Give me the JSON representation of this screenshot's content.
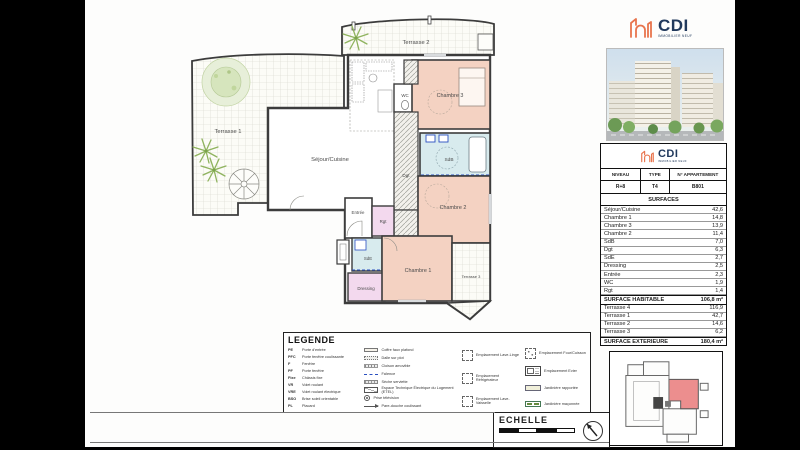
{
  "branding": {
    "name": "CDI",
    "tagline": "IMMOBILIER NEUF"
  },
  "info_table": {
    "headers": [
      "NIVEAU",
      "TYPE",
      "N° APPARTEMENT"
    ],
    "values": [
      "R+8",
      "T4",
      "B801"
    ],
    "section_title": "SURFACES",
    "rooms": [
      {
        "label": "Séjour/Cuisine",
        "value": "42,6"
      },
      {
        "label": "Chambre 1",
        "value": "14,8"
      },
      {
        "label": "Chambre 3",
        "value": "13,9"
      },
      {
        "label": "Chambre 2",
        "value": "11,4"
      },
      {
        "label": "SdB",
        "value": "7,0"
      },
      {
        "label": "Dgt",
        "value": "6,3"
      },
      {
        "label": "SdE",
        "value": "2,7"
      },
      {
        "label": "Dressing",
        "value": "2,5"
      },
      {
        "label": "Entrée",
        "value": "2,3"
      },
      {
        "label": "WC",
        "value": "1,9"
      },
      {
        "label": "Rgt",
        "value": "1,4"
      }
    ],
    "habitable": {
      "label": "SURFACE HABITABLE",
      "value": "106,8 m²"
    },
    "terraces": [
      {
        "label": "Terrasse 4",
        "value": "116,9"
      },
      {
        "label": "Terrasse 1",
        "value": "42,7"
      },
      {
        "label": "Terrasse 2",
        "value": "14,6"
      },
      {
        "label": "Terrasse 3",
        "value": "6,2"
      }
    ],
    "exterior": {
      "label": "SURFACE EXTERIEURE",
      "value": "180,4 m²"
    }
  },
  "plan": {
    "rooms": {
      "terrasse2": "Terrasse 2",
      "terrasse1": "Terrasse 1",
      "sejour": "Séjour/Cuisine",
      "chambre3": "Chambre 3",
      "wc": "WC",
      "sdb": "SdB",
      "dgt": "Dgt",
      "chambre2": "Chambre 2",
      "entree": "Entrée",
      "rgt": "Rgt",
      "sde": "SdE",
      "dressing": "Dressing",
      "chambre1": "Chambre 1",
      "terrasse3": "Terrasse 3"
    }
  },
  "legend": {
    "title": "LEGENDE",
    "abbreviations": [
      {
        "abbr": "PE",
        "label": "Porte d'entrée"
      },
      {
        "abbr": "PFC",
        "label": "Porte fenêtre coulissante"
      },
      {
        "abbr": "F",
        "label": "Fenêtre"
      },
      {
        "abbr": "PF",
        "label": "Porte fenêtre"
      },
      {
        "abbr": "Fixe",
        "label": "Châssis fixe"
      },
      {
        "abbr": "VR",
        "label": "Volet roulant"
      },
      {
        "abbr": "VRE",
        "label": "Volet roulant électrique"
      },
      {
        "abbr": "BSO",
        "label": "Brise soleil orientable"
      },
      {
        "abbr": "PL",
        "label": "Placard"
      }
    ],
    "symbols": [
      {
        "icon": "coffre-faux-plafond",
        "label": "Coffre faux plafond"
      },
      {
        "icon": "dalle-sur-plot",
        "label": "Dalle sur plot"
      },
      {
        "icon": "cloison-amovible",
        "label": "Cloison amovible"
      },
      {
        "icon": "faience",
        "label": "Faïence"
      },
      {
        "icon": "seche-serviette",
        "label": "Sèche serviette"
      },
      {
        "icon": "etel",
        "label": "Espace Technique Électrique du Logement (ETEL)"
      },
      {
        "icon": "prise-television",
        "label": "Prise télévision"
      },
      {
        "icon": "pare-douche",
        "label": "Pare-douche coulissant"
      }
    ],
    "emplacements_left": [
      "Emplacement Lave-Linge",
      "Emplacement Réfrigérateur",
      "Emplacement Lave-Vaisselle"
    ],
    "emplacements_right": [
      "Emplacement Four/Cuisson",
      "Emplacement Evier",
      "Jardinière rapportée",
      "Jardinière maçonnée"
    ]
  },
  "echelle": {
    "label": "ECHELLE"
  },
  "colors": {
    "bedroom": "#f4d2c2",
    "bathroom": "#d8ebee",
    "storage": "#f3d9ee",
    "keyplan_unit": "#ec8e8e",
    "brand_orange": "#e8744d",
    "brand_navy": "#21395c"
  }
}
